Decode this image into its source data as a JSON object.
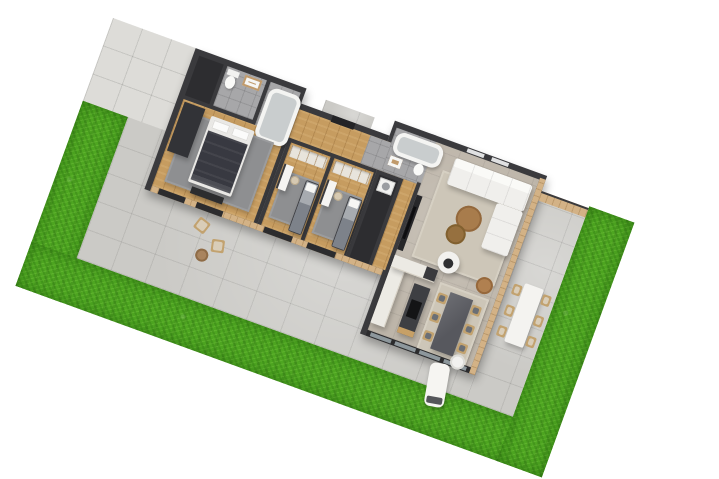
{
  "scene": {
    "title": "3D floor plan render of a single-storey house with garden",
    "type": "architectural-3d-floor-plan",
    "background_color": "#ffffff",
    "plot_rotation_deg": 20
  },
  "palette": {
    "grass": "#4ea621",
    "patio_concrete": "#cbcac6",
    "driveway_tiles": "#dddcd8",
    "exterior_wall": "#3a3a3d",
    "wood_floor": "#c69c60",
    "gray_tile": "#a7a7a9",
    "living_floor": "#bdb5a9",
    "wood_cladding": "#d3b286",
    "sofa_white": "#f0efec",
    "island_dark": "#3e3f43",
    "dining_table_dark": "#57585e",
    "chair_wood": "#c2a26f",
    "rug_gray": "#8e8f91",
    "rug_beige": "#cdc6b8"
  },
  "rooms": [
    {
      "name": "master-bedroom",
      "floor": "wood",
      "furniture": [
        "double-bed",
        "dark-wardrobe",
        "foot-bench",
        "gray-rug"
      ]
    },
    {
      "name": "bathroom-1",
      "floor": "gray-tile",
      "fixtures": [
        "toilet",
        "wood-vanity-sink"
      ]
    },
    {
      "name": "bathtub-room",
      "floor": "gray-tile",
      "fixtures": [
        "bathtub"
      ]
    },
    {
      "name": "hallway-entry",
      "floor": "wood",
      "features": [
        "front-door",
        "porch"
      ]
    },
    {
      "name": "bedroom-2",
      "floor": "wood",
      "furniture": [
        "desk",
        "desk-chair",
        "single-bed",
        "built-in-wardrobe",
        "gray-rug"
      ]
    },
    {
      "name": "bedroom-3",
      "floor": "wood",
      "furniture": [
        "desk",
        "desk-chair",
        "single-bed",
        "built-in-wardrobe",
        "gray-rug"
      ]
    },
    {
      "name": "bathroom-2",
      "floor": "gray-tile",
      "fixtures": [
        "bathtub",
        "sink",
        "toilet"
      ]
    },
    {
      "name": "laundry",
      "floor": "dark",
      "appliances": [
        "washing-machine"
      ]
    },
    {
      "name": "open-plan-living-kitchen-dining",
      "floor": "concrete-tile",
      "furniture": [
        "corner-sofa",
        "round-coffee-table-large",
        "round-coffee-table-small",
        "white-armchair",
        "rattan-chair",
        "tv-media-wall",
        "kitchen-counter-L",
        "kitchen-island-with-cooktop",
        "dark-dining-table",
        "six-dining-chairs",
        "beige-rug"
      ]
    }
  ],
  "outdoor": {
    "areas": [
      "tiled-driveway",
      "concrete-patio",
      "l-shaped-lawn",
      "entry-porch",
      "alfresco-patio"
    ],
    "furniture": [
      "outdoor-dining-table-white",
      "six-outdoor-chairs",
      "sun-lounger",
      "round-side-table",
      "two-lounge-chairs",
      "small-round-garden-table"
    ]
  }
}
